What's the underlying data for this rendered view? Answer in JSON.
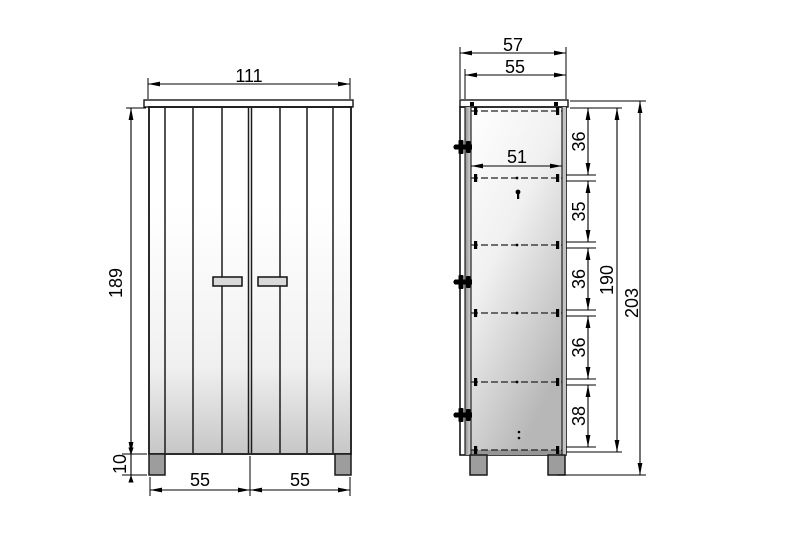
{
  "drawing_title": "wardrobe-two-view-dimension-drawing",
  "front_view": {
    "width": "111",
    "height": "189",
    "leg_height": "10",
    "door_width_left": "55",
    "door_width_right": "55"
  },
  "side_view": {
    "depth_total": "57",
    "depth_body": "55",
    "shelf_depth": "51",
    "compartments": [
      "36",
      "35",
      "36",
      "36",
      "38"
    ],
    "inner_height": "190",
    "total_height": "203"
  },
  "colors": {
    "line": "#000000",
    "panel_dark": "#a2a2a2",
    "panel_light": "#ffffff",
    "leg": "#9d9d9d"
  }
}
